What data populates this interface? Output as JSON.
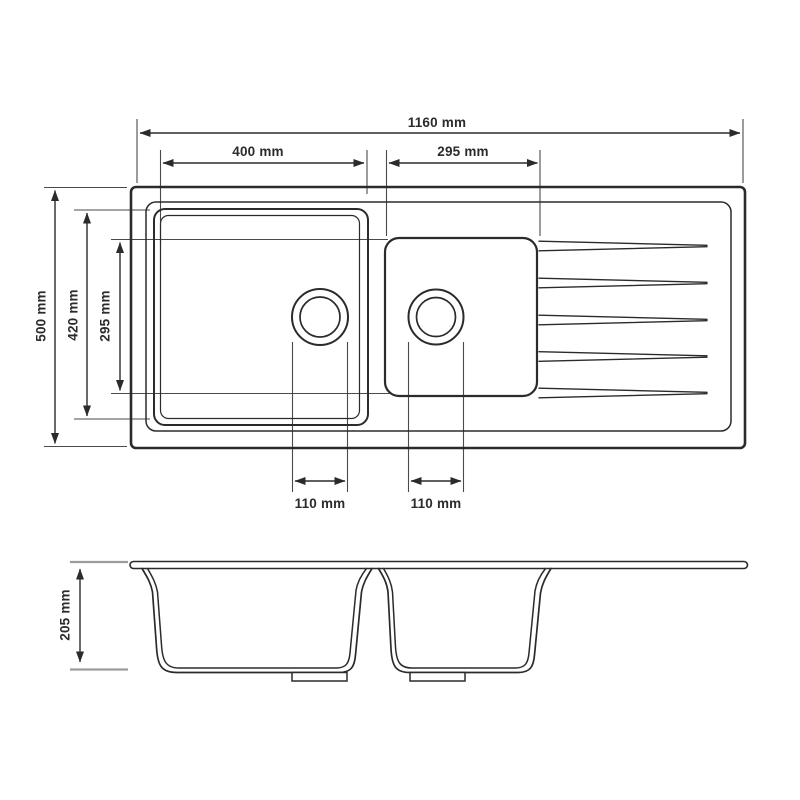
{
  "diagram": {
    "subject": "double-bowl-sink-with-drainer-technical-drawing",
    "colors": {
      "line": "#2b2b2b",
      "extension_gray": "#9c9c9c",
      "background": "#ffffff"
    },
    "top_view": {
      "overall_width": "1160 mm",
      "left_bowl_width": "400 mm",
      "right_bowl_width": "295 mm",
      "overall_depth": "500 mm",
      "left_bowl_length": "420 mm",
      "right_bowl_length": "295 mm",
      "left_drain_offset": "110 mm",
      "right_drain_offset": "110 mm",
      "groove_count": 5
    },
    "side_view": {
      "bowl_depth": "205 mm"
    }
  }
}
